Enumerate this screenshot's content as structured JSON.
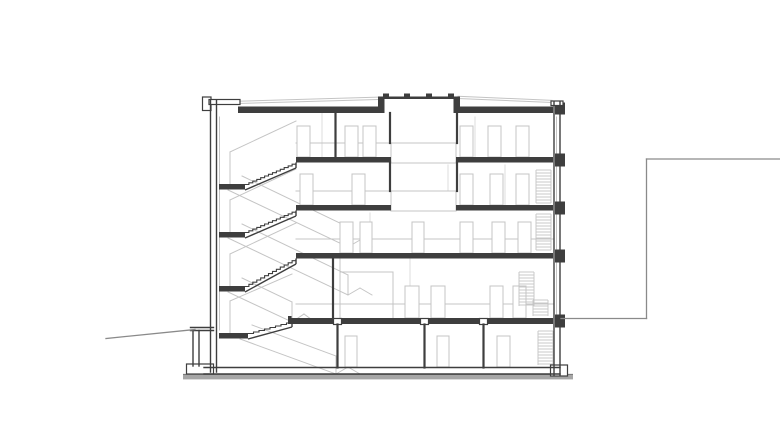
{
  "drawing": {
    "canvas": {
      "width": 780,
      "height": 448,
      "background": "#ffffff"
    },
    "palette": {
      "cut": "#3e3e3e",
      "medium": "#8a8a8a",
      "light": "#c4c4c4",
      "xlight": "#dcdcdc",
      "ground_fill": "#a6a6a6",
      "ground_line": "#6e6e6e",
      "white": "#ffffff"
    },
    "ground_strip": {
      "x": 183,
      "y": 374.8,
      "w": 390,
      "h": 4.6
    },
    "slabs": [
      [
        238,
        106.5,
        140,
        6.5
      ],
      [
        458,
        106.5,
        95,
        6.5
      ],
      [
        296,
        157,
        95,
        5.5
      ],
      [
        456,
        157,
        97,
        5.5
      ],
      [
        296,
        205,
        95,
        5.5
      ],
      [
        456,
        205,
        97,
        5.5
      ],
      [
        296,
        253,
        257,
        5.5
      ],
      [
        290,
        318,
        263,
        6
      ],
      [
        219,
        184,
        26,
        5.5
      ],
      [
        219,
        232,
        26,
        5.5
      ],
      [
        219,
        286,
        26,
        5.5
      ],
      [
        219,
        333,
        29,
        5.5
      ],
      [
        378,
        96.5,
        82,
        2.5
      ],
      [
        383,
        93.5,
        6,
        3
      ],
      [
        404,
        93.5,
        6,
        3
      ],
      [
        426,
        93.5,
        6,
        3
      ],
      [
        448,
        93.5,
        6,
        3
      ],
      [
        378,
        99,
        6.5,
        14
      ],
      [
        453.5,
        99,
        6.5,
        14
      ],
      [
        555,
        102.5,
        10,
        12
      ],
      [
        555,
        153.5,
        10,
        13
      ],
      [
        555,
        201.5,
        10,
        13
      ],
      [
        555,
        249.5,
        10,
        13
      ],
      [
        555,
        314.5,
        10,
        13
      ],
      [
        288,
        316,
        3.5,
        8
      ]
    ],
    "outlined_rects": [
      [
        202.5,
        97,
        8.5,
        13.5
      ],
      [
        209,
        99.5,
        31,
        5
      ],
      [
        551,
        101,
        12,
        4.5
      ],
      [
        186.5,
        364,
        27,
        10
      ],
      [
        550.5,
        365,
        17,
        11
      ],
      [
        333.5,
        318.5,
        8,
        6
      ],
      [
        420.5,
        318.5,
        8,
        6
      ],
      [
        479.5,
        318.5,
        8,
        6
      ]
    ],
    "center_boxes": [
      [
        391,
        143,
        65,
        20
      ],
      [
        391,
        191,
        65,
        20
      ]
    ],
    "doors": [
      [
        297,
        126,
        13,
        31
      ],
      [
        345,
        126,
        13,
        31
      ],
      [
        363,
        126,
        13,
        31
      ],
      [
        460,
        126,
        13,
        31
      ],
      [
        488,
        126,
        13,
        31
      ],
      [
        516,
        126,
        13,
        31
      ],
      [
        300,
        174,
        13,
        31
      ],
      [
        352,
        174,
        13,
        31
      ],
      [
        460,
        174,
        13,
        31
      ],
      [
        490,
        174,
        13,
        31
      ],
      [
        516,
        174,
        13,
        31
      ],
      [
        340,
        222,
        13,
        31
      ],
      [
        360,
        222,
        12,
        31
      ],
      [
        412,
        222,
        12,
        31
      ],
      [
        460,
        222,
        13,
        31
      ],
      [
        492,
        222,
        13,
        31
      ],
      [
        518,
        222,
        13,
        31
      ],
      [
        405,
        286,
        14,
        32
      ],
      [
        431,
        286,
        14,
        32
      ],
      [
        490,
        286,
        13,
        32
      ],
      [
        513,
        286,
        13,
        32
      ],
      [
        345,
        336,
        12,
        31
      ],
      [
        437,
        336,
        12,
        31
      ],
      [
        497,
        336,
        13,
        31
      ]
    ],
    "stripe_blocks": [
      {
        "x": 536,
        "y": 170,
        "w": 15,
        "h": 33,
        "step": 3
      },
      {
        "x": 536,
        "y": 214,
        "w": 15,
        "h": 36,
        "step": 3
      },
      {
        "x": 519,
        "y": 272,
        "w": 15,
        "h": 34,
        "step": 3
      },
      {
        "x": 533,
        "y": 300,
        "w": 15,
        "h": 16,
        "step": 3
      },
      {
        "x": 538,
        "y": 331,
        "w": 15,
        "h": 34,
        "step": 3
      }
    ],
    "lines_cut_thin": [
      [
        210.5,
        100,
        210.5,
        372
      ],
      [
        216.5,
        100,
        216.5,
        372
      ],
      [
        554,
        102,
        554,
        375
      ],
      [
        560,
        102,
        560,
        375
      ],
      [
        204,
        367.5,
        560,
        367.5
      ],
      [
        204,
        374,
        560,
        374
      ],
      [
        190.5,
        327.5,
        213.5,
        327.5
      ],
      [
        190.5,
        330.5,
        213.5,
        330.5
      ],
      [
        193,
        330.5,
        193,
        366
      ],
      [
        199,
        330.5,
        199,
        366
      ]
    ],
    "lines_cut_thick": [
      [
        333,
        259,
        333,
        318
      ],
      [
        335.5,
        113,
        335.5,
        157
      ],
      [
        390,
        113,
        390,
        143
      ],
      [
        457,
        113,
        457,
        143
      ],
      [
        390,
        162.5,
        390,
        191
      ],
      [
        457,
        162.5,
        457,
        191
      ],
      [
        337.5,
        324.5,
        337.5,
        367.5
      ],
      [
        424.5,
        324.5,
        424.5,
        367.5
      ],
      [
        483.5,
        324.5,
        483.5,
        367.5
      ]
    ],
    "lines_medium": [
      [
        561,
        318.5,
        646.5,
        318.5
      ],
      [
        646.5,
        159,
        646.5,
        318.5
      ],
      [
        646.5,
        159,
        780,
        159
      ],
      [
        106,
        338.5,
        195,
        329.5
      ]
    ],
    "lines_light": [
      [
        238,
        103.5,
        378,
        99.5
      ],
      [
        238,
        101.2,
        378,
        97.2
      ],
      [
        458,
        98.5,
        552,
        102.5
      ],
      [
        458,
        96.3,
        552,
        100.3
      ],
      [
        296,
        143,
        391,
        143
      ],
      [
        296,
        191,
        391,
        191
      ],
      [
        296,
        239,
        553,
        239
      ],
      [
        296,
        304,
        553,
        304
      ],
      [
        219.5,
        117,
        219.5,
        330
      ],
      [
        556.5,
        117,
        556.5,
        314
      ],
      [
        340,
        272,
        393,
        272
      ],
      [
        393,
        272,
        393,
        318
      ],
      [
        340,
        259,
        340,
        318
      ],
      [
        230,
        152,
        230,
        184
      ],
      [
        230,
        152,
        296,
        121
      ],
      [
        228,
        190,
        348,
        247
      ],
      [
        242,
        176,
        348,
        227
      ],
      [
        348,
        227,
        348,
        247
      ],
      [
        348,
        247,
        360,
        240
      ],
      [
        360,
        240,
        372,
        247
      ],
      [
        230,
        200,
        230,
        232
      ],
      [
        230,
        200,
        296,
        169
      ],
      [
        228,
        238,
        348,
        295
      ],
      [
        242,
        224,
        348,
        275
      ],
      [
        348,
        275,
        348,
        295
      ],
      [
        348,
        295,
        360,
        288
      ],
      [
        360,
        288,
        372,
        295
      ],
      [
        230,
        254,
        230,
        286
      ],
      [
        230,
        254,
        296,
        223
      ],
      [
        228,
        292,
        292,
        322
      ],
      [
        242,
        278,
        292,
        302
      ],
      [
        292,
        302,
        292,
        322
      ],
      [
        292,
        322,
        304,
        314
      ],
      [
        304,
        314,
        315,
        322
      ],
      [
        230,
        301,
        230,
        333
      ],
      [
        230,
        301,
        292,
        274
      ],
      [
        240,
        339,
        336,
        374
      ],
      [
        252,
        325,
        336,
        356
      ],
      [
        336,
        356,
        336,
        374
      ],
      [
        336,
        374,
        348,
        367
      ],
      [
        348,
        367,
        360,
        374
      ]
    ],
    "lines_xlight": [
      [
        322,
        113,
        322,
        157
      ],
      [
        475,
        117,
        475,
        157
      ],
      [
        448,
        165,
        448,
        205
      ],
      [
        505,
        165,
        505,
        205
      ],
      [
        370,
        213,
        370,
        253
      ],
      [
        410,
        259,
        410,
        318
      ]
    ],
    "stairs": [
      {
        "lx": 245,
        "ly": 184.5,
        "tx": 296,
        "ty": 162.5,
        "steps": 13
      },
      {
        "lx": 245,
        "ly": 232.5,
        "tx": 296,
        "ty": 210.5,
        "steps": 13
      },
      {
        "lx": 245,
        "ly": 286.5,
        "tx": 296,
        "ty": 258.5,
        "steps": 13
      },
      {
        "lx": 248,
        "ly": 333.5,
        "tx": 292,
        "ty": 321.5,
        "steps": 8
      }
    ]
  }
}
